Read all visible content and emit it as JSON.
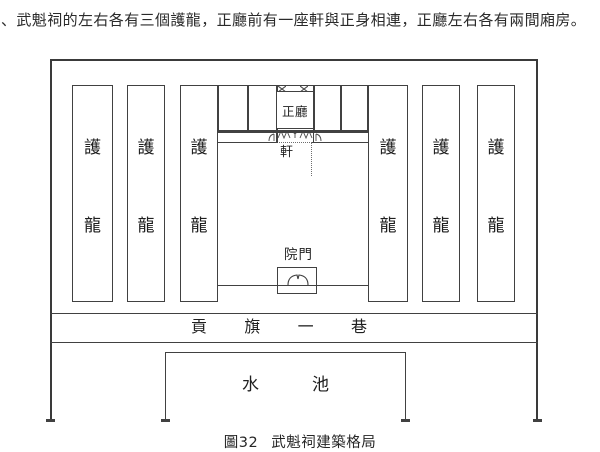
{
  "page": {
    "intro_text": "、武魁祠的左右各有三個護龍，正廳前有一座軒與正身相連，正廳左右各有兩間廂房。",
    "figure_caption": {
      "number": "圖32",
      "title": "武魁祠建築格局"
    }
  },
  "diagram": {
    "wing": {
      "top_char": "護",
      "bottom_char": "龍"
    },
    "main_hall_label": "正廳",
    "porch_label": "軒",
    "gate_label": "院門",
    "lane_chars": [
      "貢",
      "旗",
      "一",
      "巷"
    ],
    "pond_chars": [
      "水",
      "池"
    ],
    "icons": {
      "door_cross": "✕",
      "hall_doors": "door-swing-marks",
      "gate_doors": "double-door-arcs"
    },
    "colors": {
      "line": "#414141",
      "text": "#1f1f1f"
    }
  }
}
